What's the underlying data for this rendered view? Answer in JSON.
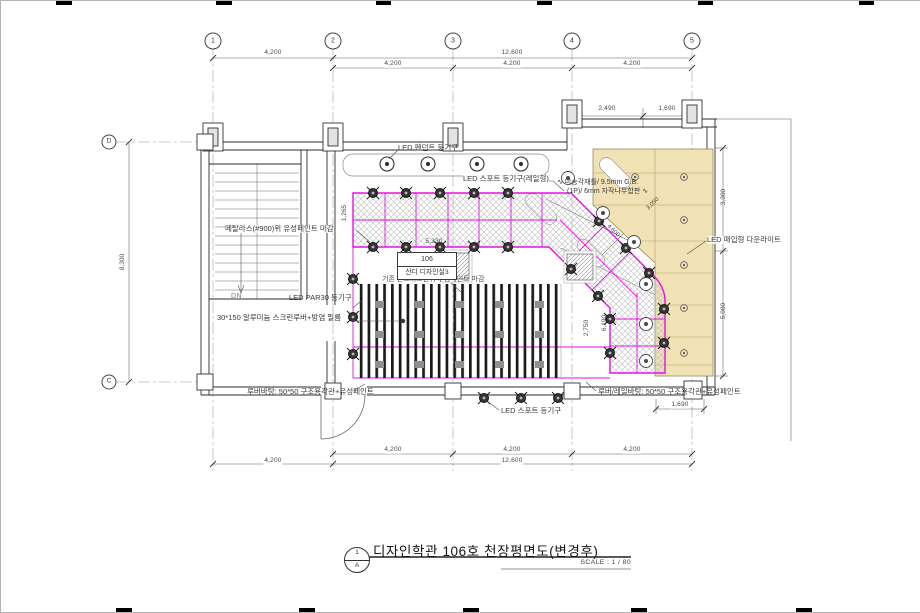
{
  "drawing": {
    "title": "디자인학관 106호 천장평면도(변경후)",
    "scale": "SCALE : 1 / 80",
    "sheet_symbol": {
      "number": "1",
      "letter": "A"
    },
    "room": {
      "number": "106",
      "name": "산디 디자인실3"
    },
    "stairs": {
      "down_label": "DN"
    },
    "grid": {
      "columns": [
        "1",
        "2",
        "3",
        "4",
        "5"
      ],
      "rows": [
        "D",
        "C"
      ]
    },
    "dims": {
      "top_span_1_2": "4,200",
      "top_span_2_5": "12,600",
      "top_sub": [
        "4,200",
        "4,200",
        "4,200"
      ],
      "top_right": [
        "2,490",
        "1,690"
      ],
      "bottom_sub": [
        "4,200",
        "4,200",
        "4,200"
      ],
      "bottom_span_1_2": "4,200",
      "bottom_span_2_5": "12,600",
      "left_total": "8,300",
      "right_upper": "3,300",
      "right_lower": "5,000",
      "bottom_right": "1,690",
      "interior": {
        "band": "5,330",
        "diag": "4,600",
        "diag_wall": "3,050",
        "vert_a": "2,750",
        "vert_b": "6,190",
        "left_edge": "1,265"
      }
    },
    "labels": {
      "pendant": "LED 펜던트 등기구",
      "spot_rail": "LED 스포트 등기구(레일형)",
      "metal_lath": "메탈라스(#900)위 유성페인트 마감",
      "par30": "LED PAR30 등기구",
      "screen_louver": "30*150 알루미늄 스크린루버+방염 필름",
      "concrete": "기존 콘크리트면위 수성페인트 마감",
      "wood_line1": "∿ 미송각재틀/ 9.5mm G.B.",
      "wood_line2": "(1P)/ 6mm 자작나무합판 ∿",
      "downlight": "LED 매입형 다운라이트",
      "louver_base": "루버바탕: 50*50 구조용각관+유성페인트",
      "spot": "LED 스포트 등기구",
      "louver_rail_base": "루버/레일바탕: 50*50 구조용각관+유성페인트"
    },
    "colors": {
      "accent_magenta": "#e312e3",
      "wood": "#f0e2b5",
      "hatch": "#bdbdbd"
    }
  }
}
